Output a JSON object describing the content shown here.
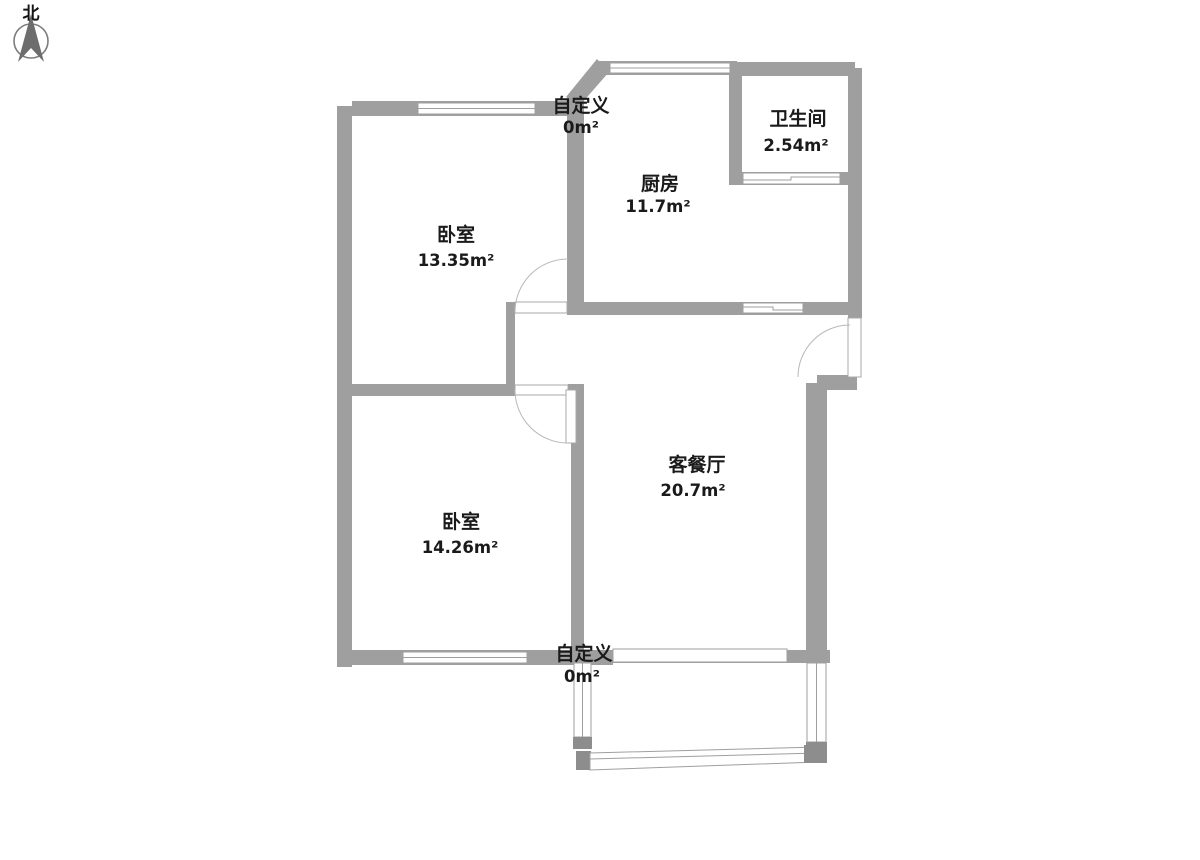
{
  "compass": {
    "label": "北"
  },
  "rooms": [
    {
      "id": "custom-top",
      "name": "自定义",
      "area": "0m²"
    },
    {
      "id": "kitchen",
      "name": "厨房",
      "area": "11.7m²"
    },
    {
      "id": "bathroom",
      "name": "卫生间",
      "area": "2.54m²"
    },
    {
      "id": "bedroom-north",
      "name": "卧室",
      "area": "13.35m²"
    },
    {
      "id": "living-dining",
      "name": "客餐厅",
      "area": "20.7m²"
    },
    {
      "id": "bedroom-south",
      "name": "卧室",
      "area": "14.26m²"
    },
    {
      "id": "custom-bottom",
      "name": "自定义",
      "area": "0m²"
    }
  ],
  "colors": {
    "wall": "#9f9f9f",
    "wall_dark": "#8d8d8d",
    "door_arc": "#b8b8b8",
    "text": "#1a1a1a",
    "background": "#ffffff"
  }
}
